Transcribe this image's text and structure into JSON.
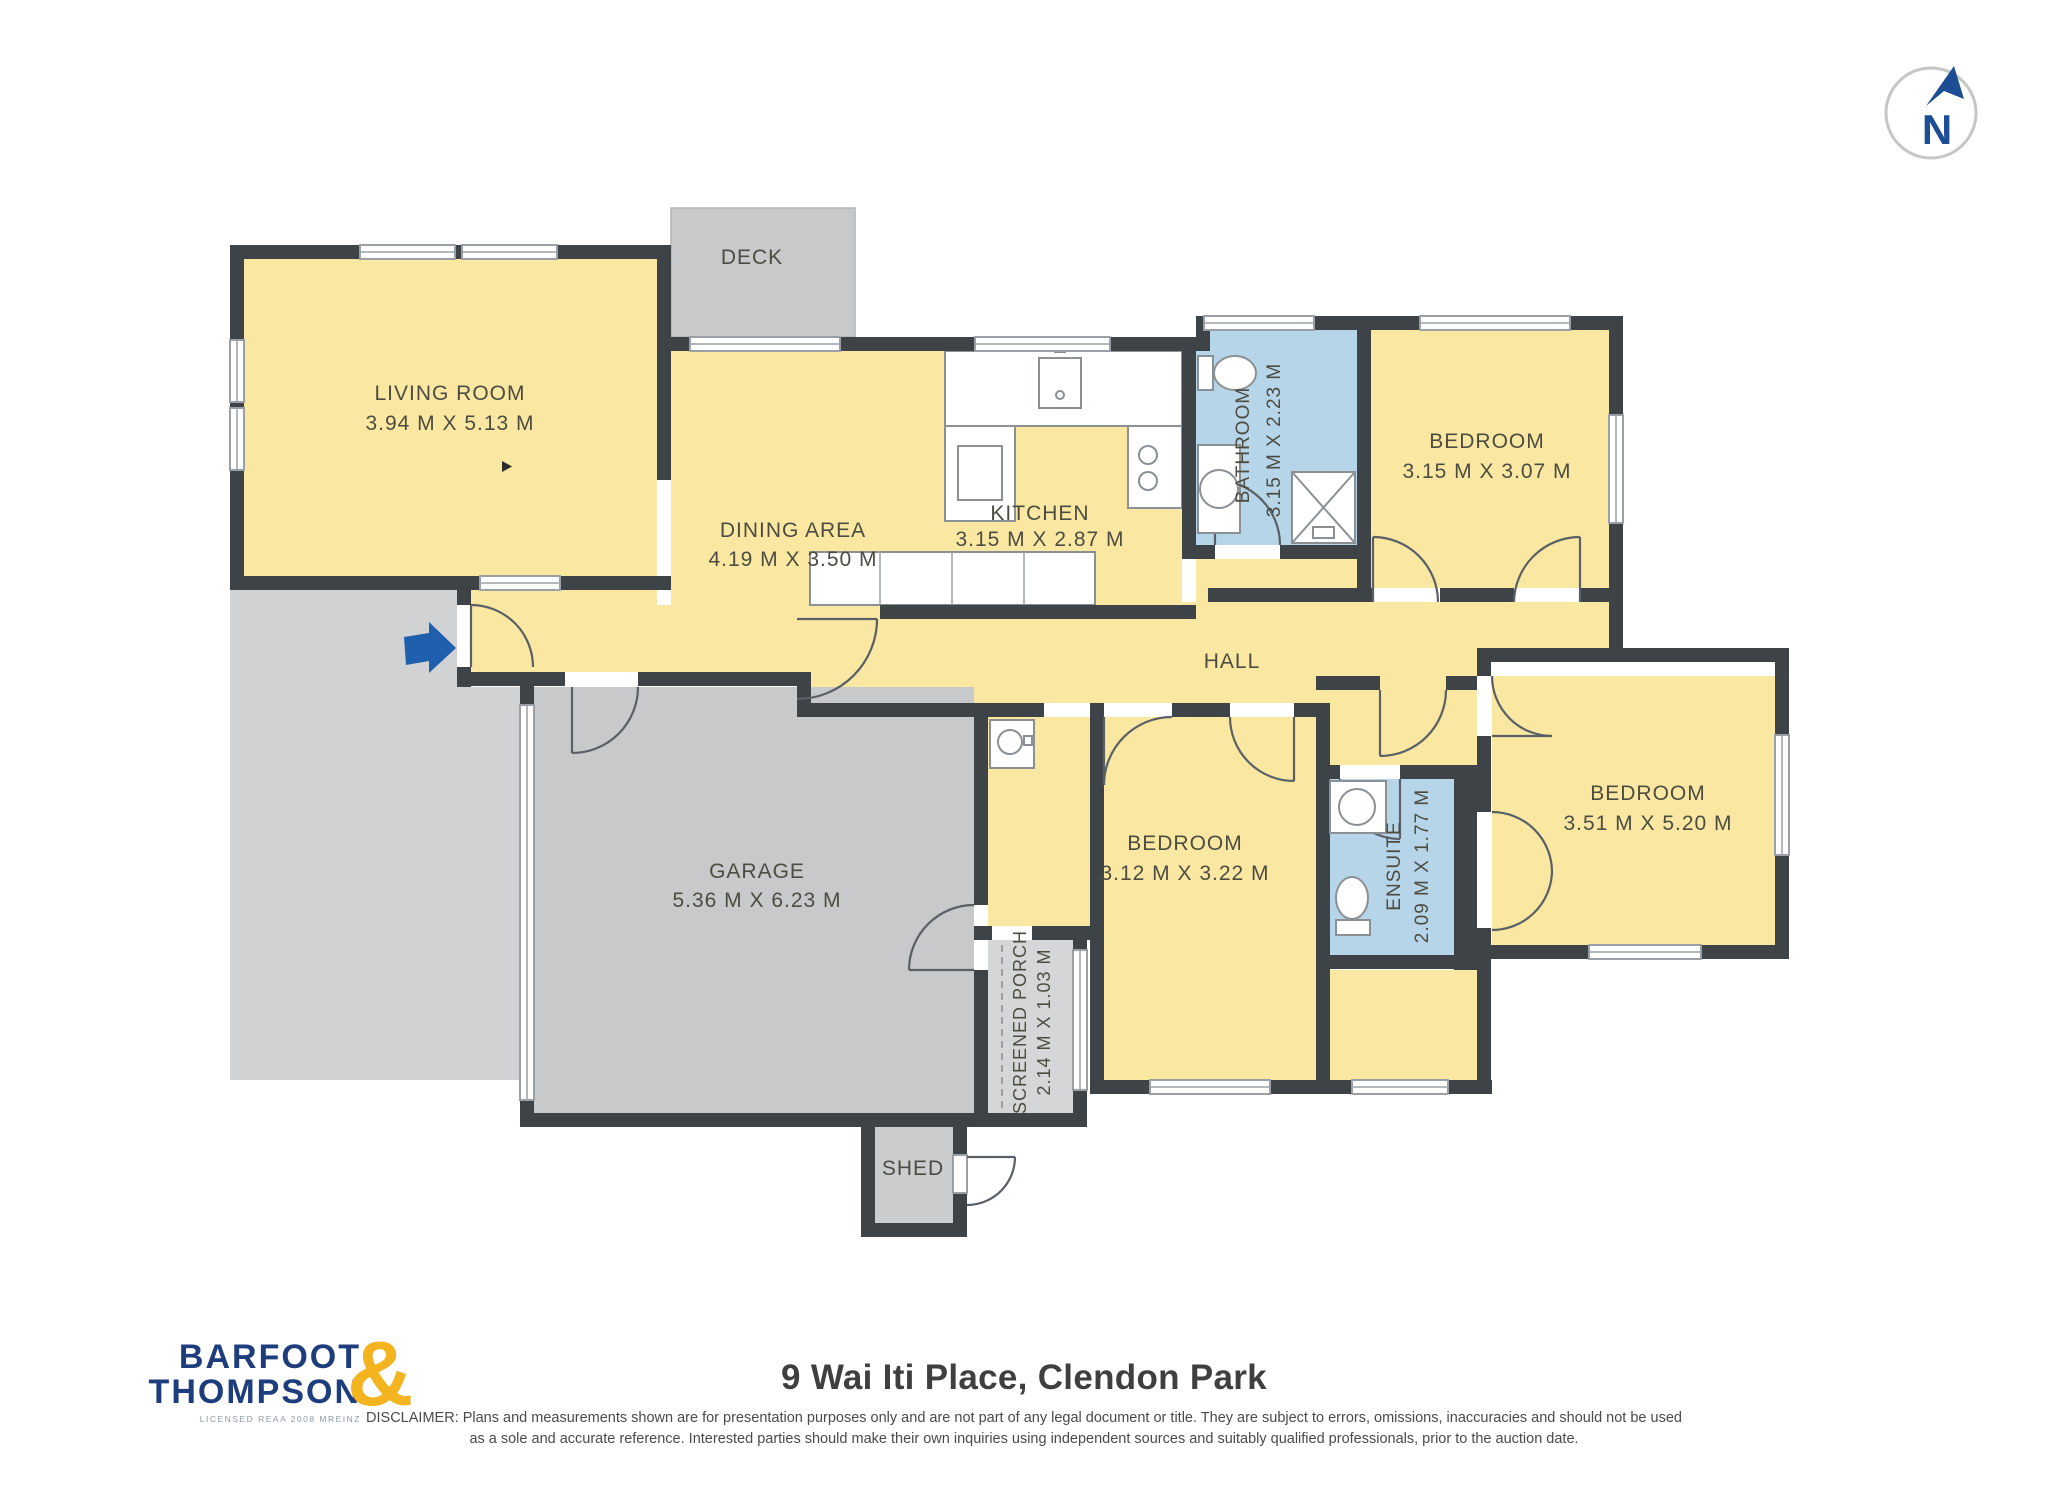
{
  "compass": {
    "letter": "N"
  },
  "rooms": {
    "living_room": {
      "name": "LIVING ROOM",
      "dims": "3.94 M X 5.13 M"
    },
    "dining_area": {
      "name": "DINING AREA",
      "dims": "4.19 M X 3.50 M"
    },
    "kitchen": {
      "name": "KITCHEN",
      "dims": "3.15 M X 2.87 M"
    },
    "bathroom": {
      "name": "BATHROOM",
      "dims": "3.15 M X 2.23 M"
    },
    "bedroom_top": {
      "name": "BEDROOM",
      "dims": "3.15 M X 3.07 M"
    },
    "hall": {
      "name": "HALL"
    },
    "bedroom_mid": {
      "name": "BEDROOM",
      "dims": "3.12 M X 3.22 M"
    },
    "ensuite": {
      "name": "ENSUITE",
      "dims": "2.09 M X 1.77 M"
    },
    "bedroom_right": {
      "name": "BEDROOM",
      "dims": "3.51 M X 5.20 M"
    },
    "garage": {
      "name": "GARAGE",
      "dims": "5.36 M X 6.23 M"
    },
    "screened_porch": {
      "name": "SCREENED PORCH",
      "dims": "2.14 M X 1.03 M"
    },
    "deck": {
      "name": "DECK"
    },
    "shed": {
      "name": "SHED"
    }
  },
  "footer": {
    "title": "9 Wai Iti Place, Clendon Park",
    "disclaimer_line1": "DISCLAIMER: Plans and measurements shown are for presentation purposes only and are not part of any legal document or title. They are subject to errors, omissions, inaccuracies and should not be used",
    "disclaimer_line2": "as a sole and accurate reference. Interested parties should make their own inquiries using independent sources and suitably qualified professionals, prior to the auction date."
  },
  "logo": {
    "word1": "BARFOOT",
    "word2": "THOMPSON",
    "ampersand": "&",
    "tagline": "LICENSED REAA 2008 MREINZ"
  },
  "colors": {
    "wall": "#3e4347",
    "room_fill": "#fae8a2",
    "wet_area_fill": "#b7d5e8",
    "garage_fill": "#c8c9ca",
    "driveway_fill": "#d1d2d3",
    "logo_navy": "#1d3d7c",
    "logo_gold": "#f4b41f",
    "entry_arrow_blue": "#1f5fae",
    "compass_navy": "#1d4d92",
    "label_text": "#4c4c42"
  }
}
